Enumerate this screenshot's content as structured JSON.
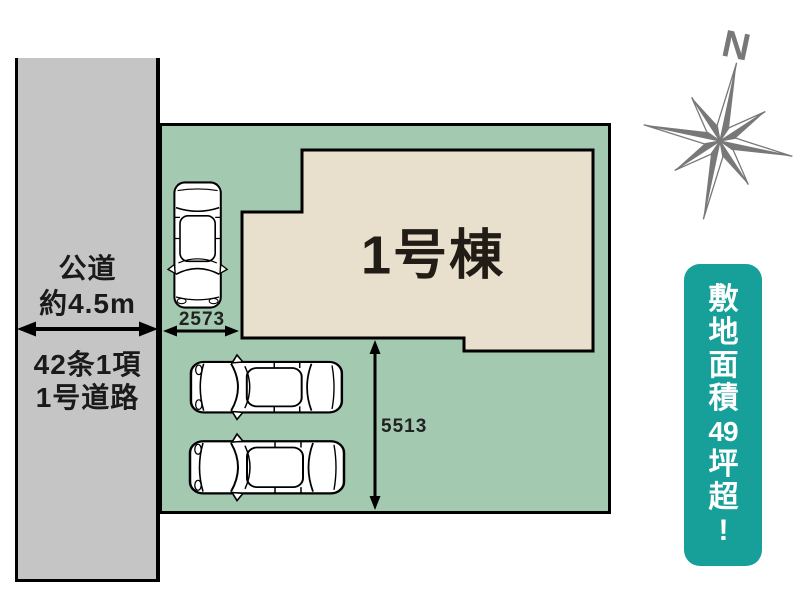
{
  "road": {
    "label_top_1": "公道",
    "label_top_2": "約4.5m",
    "label_bottom_1": "42条1項",
    "label_bottom_2": "1号道路"
  },
  "building": {
    "label": "1号棟"
  },
  "dimensions": {
    "parking_width_mm": "2573",
    "parking_depth_mm": "5513"
  },
  "compass": {
    "north": "N"
  },
  "badge": {
    "text": "敷地面積49坪超!",
    "chars": [
      "敷",
      "地",
      "面",
      "積",
      "49",
      "坪",
      "超",
      "!"
    ]
  },
  "colors": {
    "road": "#c5c5c5",
    "plot": "#a3c9b1",
    "building": "#e8e0cc",
    "outline": "#000000",
    "badge": "#17a099",
    "badge_text": "#ffffff",
    "compass": "#787878",
    "label_text": "#1a1a1a"
  }
}
